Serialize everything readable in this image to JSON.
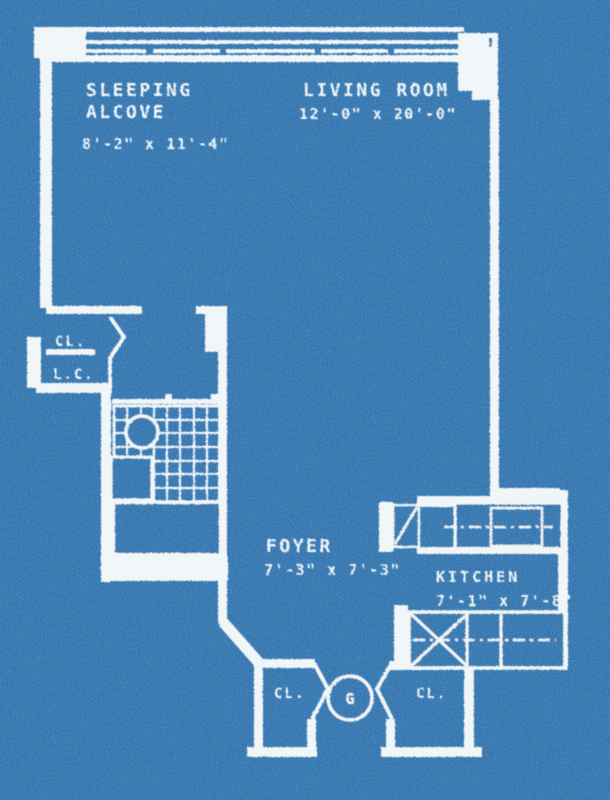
{
  "title": "Apartment floor plan blueprint",
  "colors": {
    "background": "#3577b0",
    "line": "#f0f5f7"
  },
  "rooms": {
    "sleeping_alcove": {
      "label_line1": "SLEEPING",
      "label_line2": "ALCOVE",
      "dimensions": "8'-2\" x 11'-4\""
    },
    "living_room": {
      "label": "LIVING ROOM",
      "dimensions": "12'-0\" x 20'-0\""
    },
    "foyer": {
      "label": "FOYER",
      "dimensions": "7'-3\" x 7'-3\""
    },
    "kitchen": {
      "label": "KITCHEN",
      "dimensions": "7'-1\" x 7'-8\""
    }
  },
  "closets": {
    "hall_closet": "CL.",
    "linen_closet": "L.C.",
    "entry_closet_left": "CL.",
    "entry_closet_right": "CL."
  },
  "annotations": {
    "garbage_chute": "G"
  }
}
